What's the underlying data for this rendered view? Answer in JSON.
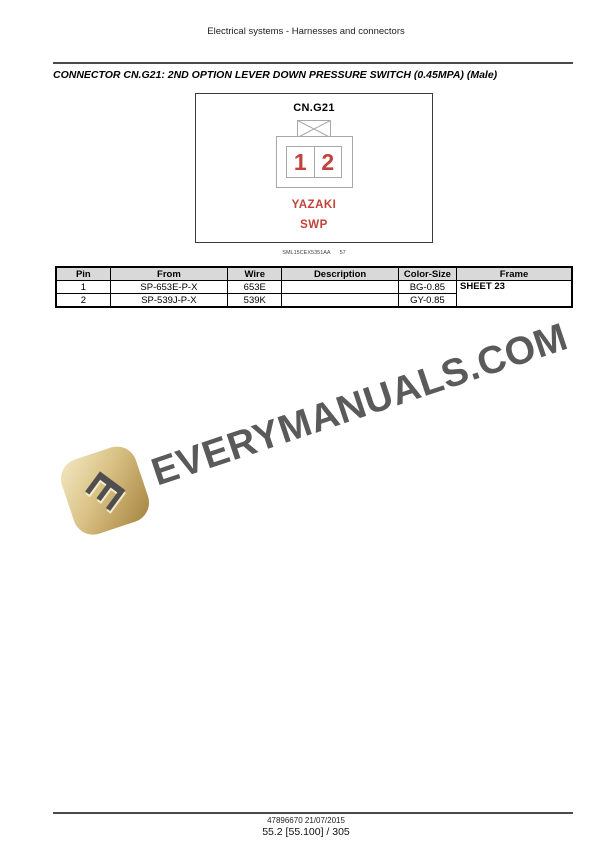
{
  "page": {
    "running_header": "Electrical systems - Harnesses and connectors",
    "title": "CONNECTOR CN.G21: 2ND OPTION LEVER DOWN PRESSURE SWITCH (0.45MPA) (Male)"
  },
  "diagram": {
    "connector_id": "CN.G21",
    "pins": [
      "1",
      "2"
    ],
    "manufacturer": "YAZAKI",
    "series": "SWP",
    "figure_code": "SML15CEX5351AA",
    "figure_number": "57"
  },
  "table": {
    "headers": [
      "Pin",
      "From",
      "Wire",
      "Description",
      "Color-Size",
      "Frame"
    ],
    "rows": [
      {
        "pin": "1",
        "from": "SP-653E-P-X",
        "wire": "653E",
        "description": "",
        "color_size": "BG-0.85",
        "frame": "SHEET 23"
      },
      {
        "pin": "2",
        "from": "SP-539J-P-X",
        "wire": "539K",
        "description": "",
        "color_size": "GY-0.85"
      }
    ]
  },
  "watermark": {
    "text": "EVERYMANUALS.COM",
    "logo_letter": "E"
  },
  "footer": {
    "doc_line": "47896670 21/07/2015",
    "page_line": "55.2 [55.100] / 305"
  },
  "colors": {
    "accent_red": "#c2423b",
    "table_header_bg": "#d9d9d9",
    "watermark_gray": "#4d4d4d",
    "logo_gold": "#c8ab6a",
    "diagram_line_gray": "#a8a8a8"
  }
}
